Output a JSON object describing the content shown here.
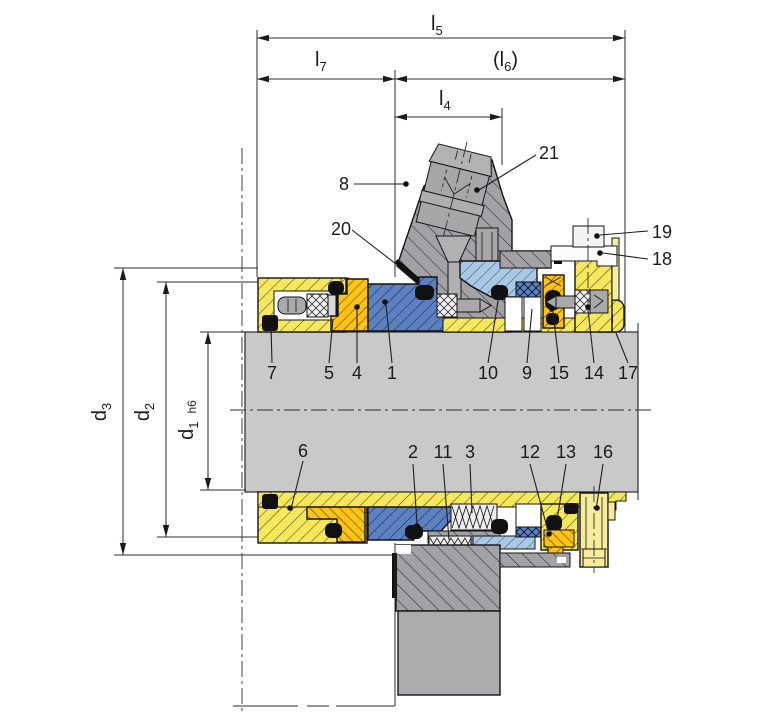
{
  "drawing": {
    "title": "Mechanical seal cross-section drawing",
    "dim_labels": {
      "l5": {
        "base": "l",
        "sub": "5"
      },
      "l7": {
        "base": "l",
        "sub": "7"
      },
      "l6": {
        "prefix": "(",
        "base": "l",
        "sub": "6",
        "suffix": ")"
      },
      "l4": {
        "base": "l",
        "sub": "4"
      },
      "d3": {
        "base": "d",
        "sub": "3"
      },
      "d2": {
        "base": "d",
        "sub": "2"
      },
      "d1": {
        "base": "d",
        "sub": "1",
        "tol": "h6"
      }
    },
    "part_numbers": {
      "p1": "1",
      "p2": "2",
      "p3": "3",
      "p4": "4",
      "p5": "5",
      "p6": "6",
      "p7": "7",
      "p8": "8",
      "p9": "9",
      "p10": "10",
      "p11": "11",
      "p12": "12",
      "p13": "13",
      "p14": "14",
      "p15": "15",
      "p16": "16",
      "p17": "17",
      "p18": "18",
      "p19": "19",
      "p20": "20",
      "p21": "21"
    },
    "colors": {
      "housing_yellow": "#F7E75C",
      "seat_gold": "#FFC217",
      "seal_ring_blue": "#5C80C0",
      "mating_ring_light_blue": "#A8C8E6",
      "metal_gray": "#A7A7AA",
      "shaft_gray": "#C9C9CA",
      "elastomer_black": "#111111",
      "outline": "#1C1C1C"
    }
  }
}
